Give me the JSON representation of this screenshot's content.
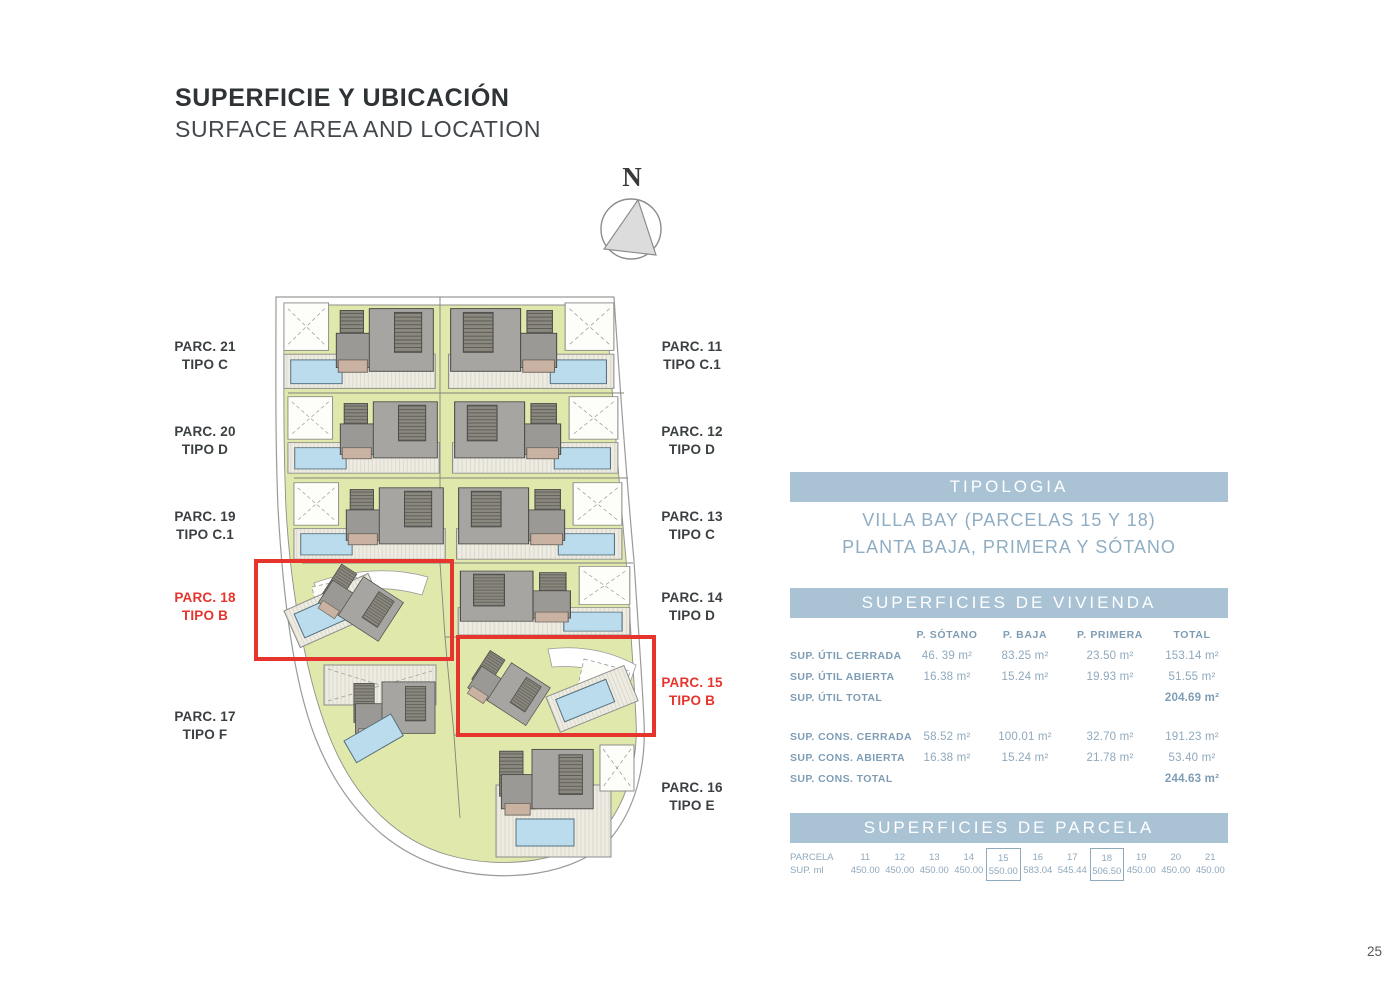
{
  "page": {
    "title": "SUPERFICIE Y UBICACIÓN",
    "subtitle": "SURFACE AREA AND LOCATION",
    "page_number": "25",
    "compass_label": "N"
  },
  "colors": {
    "band_blue": "#a9c3d4",
    "heading_blue": "#7e9db5",
    "text_blue": "#8fa9bd",
    "highlight_red": "#e5352c",
    "plan_green": "#e0e8ab",
    "pool_blue": "#badcec",
    "building_gray": "#a7a5a1"
  },
  "plan": {
    "left_labels": [
      {
        "parcel": "PARC. 21",
        "type": "TIPO C",
        "highlight": false
      },
      {
        "parcel": "PARC. 20",
        "type": "TIPO D",
        "highlight": false
      },
      {
        "parcel": "PARC. 19",
        "type": "TIPO C.1",
        "highlight": false
      },
      {
        "parcel": "PARC. 18",
        "type": "TIPO B",
        "highlight": true
      },
      {
        "parcel": "PARC. 17",
        "type": "TIPO F",
        "highlight": false
      }
    ],
    "right_labels": [
      {
        "parcel": "PARC. 11",
        "type": "TIPO C.1",
        "highlight": false
      },
      {
        "parcel": "PARC. 12",
        "type": "TIPO D",
        "highlight": false
      },
      {
        "parcel": "PARC. 13",
        "type": "TIPO C",
        "highlight": false
      },
      {
        "parcel": "PARC. 14",
        "type": "TIPO D",
        "highlight": false
      },
      {
        "parcel": "PARC. 15",
        "type": "TIPO B",
        "highlight": true
      },
      {
        "parcel": "PARC. 16",
        "type": "TIPO E",
        "highlight": false
      }
    ]
  },
  "tipologia": {
    "header": "TIPOLOGIA",
    "line1": "VILLA BAY (PARCELAS 15 Y 18)",
    "line2": "PLANTA BAJA, PRIMERA Y SÓTANO"
  },
  "vivienda": {
    "header": "SUPERFICIES DE VIVIENDA",
    "columns": [
      "P. SÓTANO",
      "P. BAJA",
      "P. PRIMERA",
      "TOTAL"
    ],
    "rows": [
      {
        "label": "SUP. ÚTIL CERRADA",
        "sotano": "46. 39 m²",
        "baja": "83.25 m²",
        "primera": "23.50 m²",
        "total": "153.14 m²"
      },
      {
        "label": "SUP. ÚTIL ABIERTA",
        "sotano": "16.38 m²",
        "baja": "15.24 m²",
        "primera": "19.93 m²",
        "total": "51.55 m²"
      },
      {
        "label": "SUP. ÚTIL TOTAL",
        "sotano": "",
        "baja": "",
        "primera": "",
        "total": "204.69 m²"
      },
      {
        "label": "SUP. CONS. CERRADA",
        "sotano": "58.52 m²",
        "baja": "100.01 m²",
        "primera": "32.70 m²",
        "total": "191.23 m²"
      },
      {
        "label": "SUP. CONS. ABIERTA",
        "sotano": "16.38 m²",
        "baja": "15.24 m²",
        "primera": "21.78 m²",
        "total": "53.40 m²"
      },
      {
        "label": "SUP. CONS. TOTAL",
        "sotano": "",
        "baja": "",
        "primera": "",
        "total": "244.63 m²"
      }
    ]
  },
  "parcela": {
    "header": "SUPERFICIES DE PARCELA",
    "row1_label": "PARCELA",
    "row2_label": "SUP. ml",
    "columns": [
      {
        "id": "11",
        "value": "450.00",
        "boxed": false
      },
      {
        "id": "12",
        "value": "450.00",
        "boxed": false
      },
      {
        "id": "13",
        "value": "450.00",
        "boxed": false
      },
      {
        "id": "14",
        "value": "450.00",
        "boxed": false
      },
      {
        "id": "15",
        "value": "550.00",
        "boxed": true
      },
      {
        "id": "16",
        "value": "583.04",
        "boxed": false
      },
      {
        "id": "17",
        "value": "545.44",
        "boxed": false
      },
      {
        "id": "18",
        "value": "506.50",
        "boxed": true
      },
      {
        "id": "19",
        "value": "450.00",
        "boxed": false
      },
      {
        "id": "20",
        "value": "450.00",
        "boxed": false
      },
      {
        "id": "21",
        "value": "450.00",
        "boxed": false
      }
    ]
  }
}
